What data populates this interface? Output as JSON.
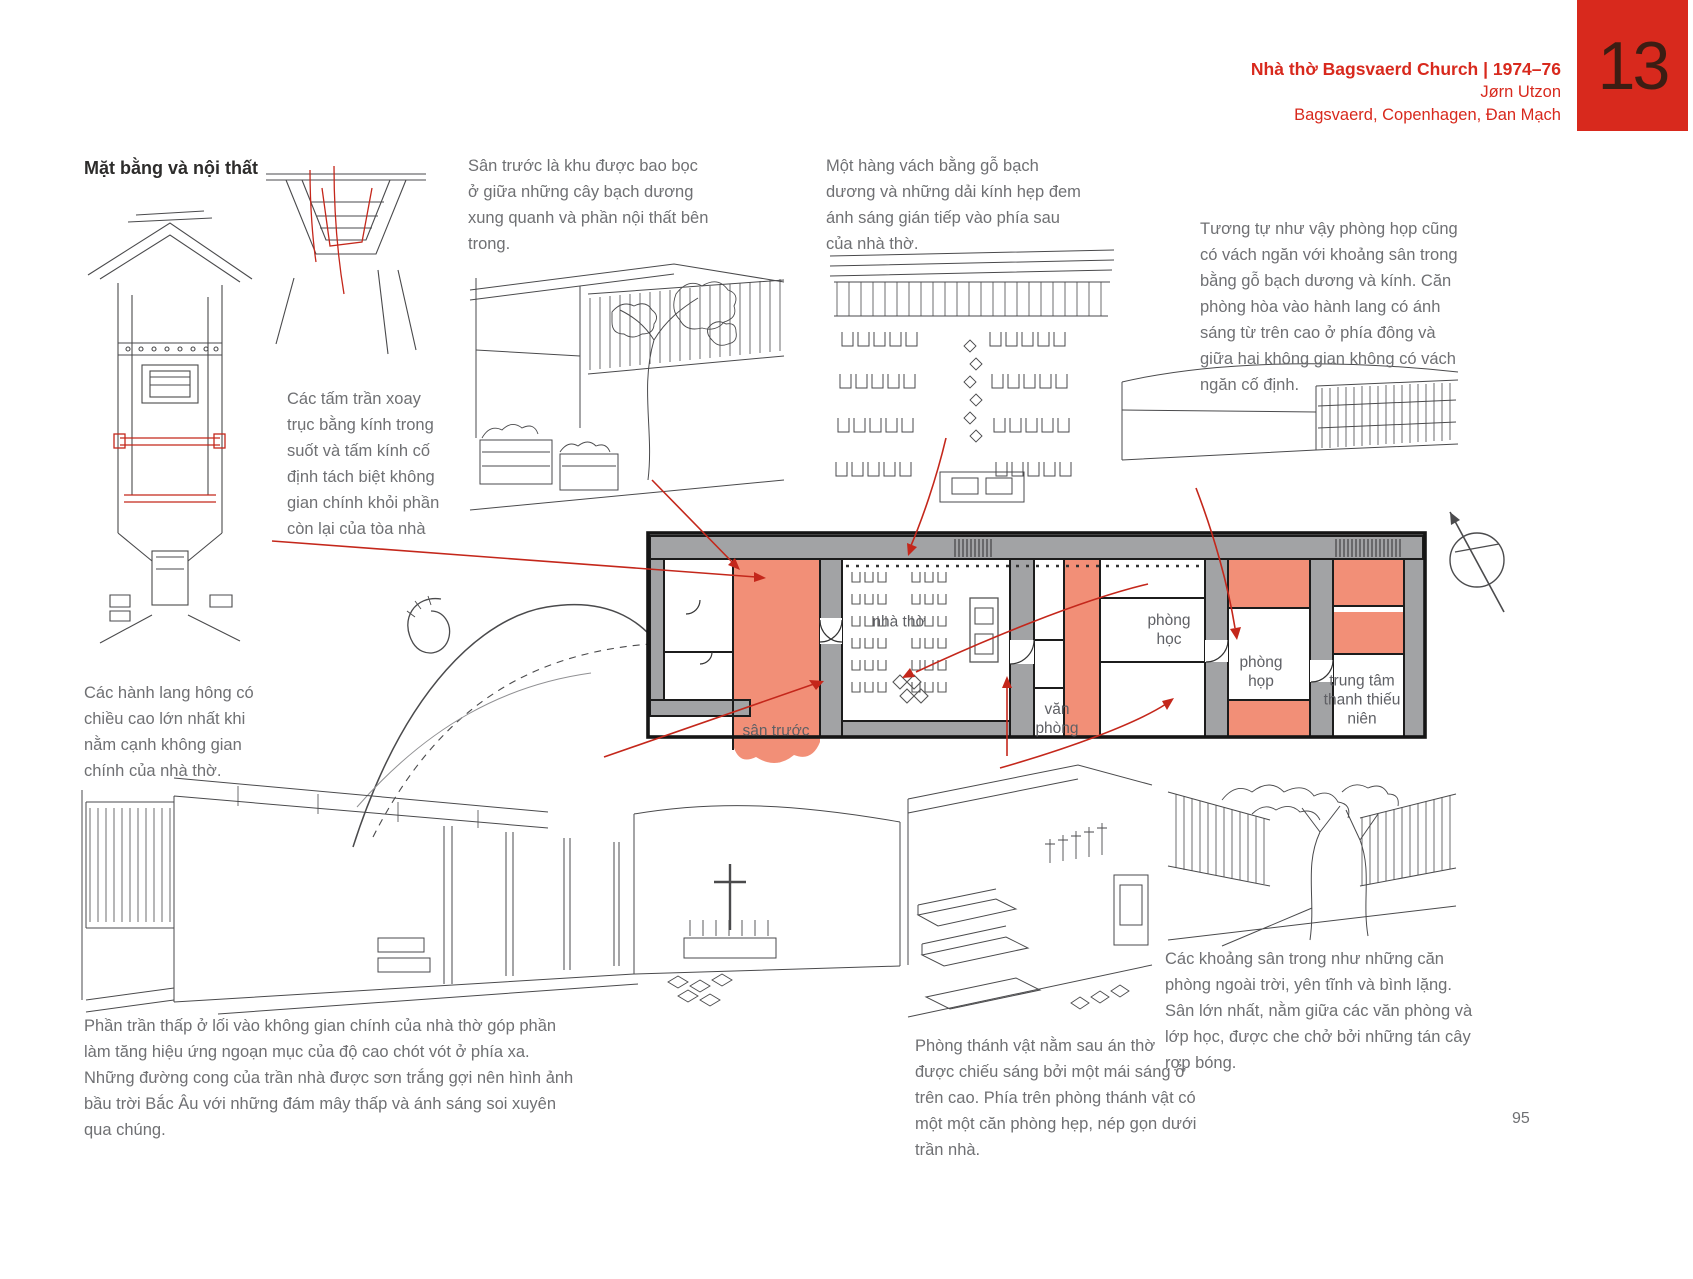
{
  "header": {
    "title": "Nhà thờ Bagsvaerd Church | 1974–76",
    "architect": "Jørn Utzon",
    "location": "Bagsvaerd, Copenhagen, Đan Mạch",
    "chapter": "13"
  },
  "heading": "Mặt bằng và nội thất",
  "annotations": {
    "front_yard": "Sân trước là khu được bao bọc ở giữa những cây bạch dương xung quanh và phần nội thất bên trong.",
    "timber_screen": "Một hàng vách bằng gỗ bạch dương và những dải kính hẹp đem ánh sáng gián tiếp vào phía sau của nhà thờ.",
    "meeting_room": "Tương tự như vậy phòng họp cũng có vách ngăn với khoảng sân trong bằng gỗ bạch dương và kính. Căn phòng hòa vào hành lang có ánh sáng từ trên cao ở phía đông và giữa hai không gian không có vách ngăn cố định.",
    "ceiling_panels": "Các tấm trần xoay trục bằng kính trong suốt và tấm kính cố định tách biệt không gian chính khỏi phần còn lại của tòa nhà",
    "side_corridors": "Các hành lang hông có chiều cao lớn nhất khi nằm cạnh không gian chính của nhà thờ.",
    "low_ceiling": "Phần trần thấp ở lối vào không gian chính của nhà thờ góp phần làm tăng hiệu ứng ngoạn mục của độ cao chót vót ở phía xa. Những đường cong của trần nhà được sơn trắng gợi nên hình ảnh bầu trời Bắc Âu với những đám mây thấp và ánh sáng soi xuyên qua chúng.",
    "sacristy": "Phòng thánh vật nằm sau án thờ được chiếu sáng bởi một mái sáng ở trên cao. Phía trên phòng thánh vật có một một căn phòng hẹp, nép gọn dưới trần nhà.",
    "courtyards": "Các khoảng sân trong như những căn phòng ngoài trời, yên tĩnh và bình lặng. Sân lớn nhất, nằm giữa các văn phòng và lớp học, được che chở bởi những tán cây rợp bóng."
  },
  "plan": {
    "church": "nhà thờ",
    "front_yard": "sân trước",
    "classroom": "phòng học",
    "meeting": "phòng họp",
    "office": "văn phòng",
    "youth_center": "trung tâm thanh thiếu niên"
  },
  "page_number": "95",
  "colors": {
    "accent_red": "#d8291d",
    "arrow_red": "#c4271b",
    "highlight_salmon": "#f28f77",
    "wall_gray": "#a2a3a5",
    "text_gray": "#6f7073"
  }
}
